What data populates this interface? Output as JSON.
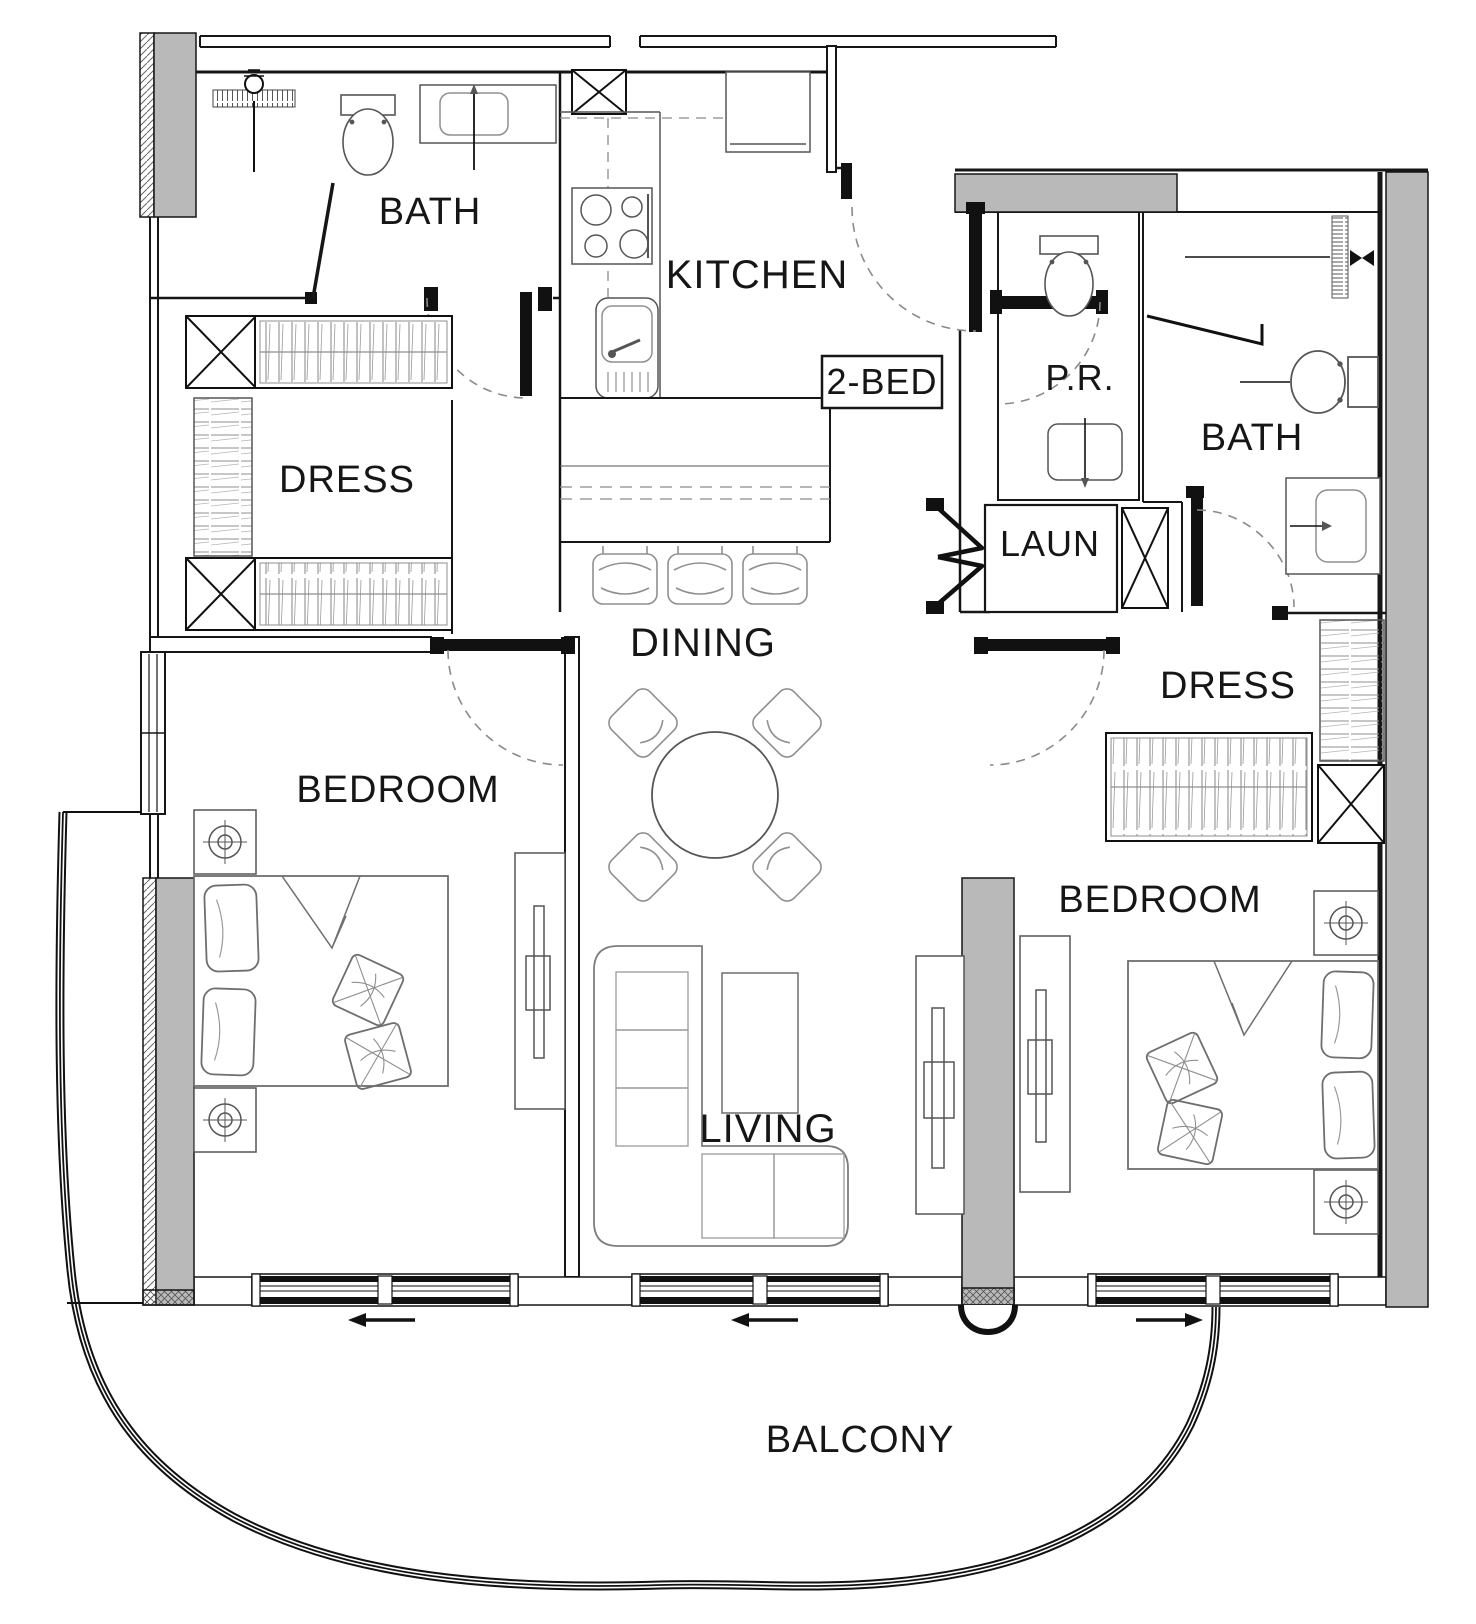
{
  "unit": {
    "type_label": "2-BED"
  },
  "rooms": {
    "bath1": "BATH",
    "kitchen": "KITCHEN",
    "dress1": "DRESS",
    "dining": "DINING",
    "bedroom1": "BEDROOM",
    "living": "LIVING",
    "pr": "P.R.",
    "laun": "LAUN",
    "bath2": "BATH",
    "dress2": "DRESS",
    "bedroom2": "BEDROOM",
    "balcony": "BALCONY"
  },
  "colors": {
    "wall": "#161616",
    "gray_fill": "#b9b9b9",
    "furniture": "#8f8f8f",
    "dash": "#8a8a8a",
    "background": "#ffffff"
  }
}
